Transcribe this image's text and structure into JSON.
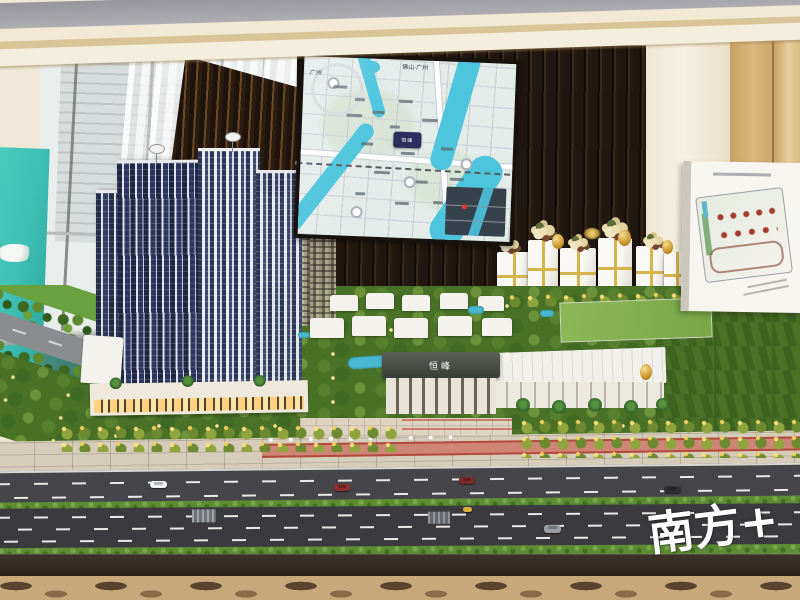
{
  "scene": {
    "kind": "photograph",
    "subject": "real-estate sales center architectural scale model with location map screen"
  },
  "watermark": {
    "text": "南方+",
    "color": "#ffffff"
  },
  "entrance_sign": {
    "text": "恒峰",
    "color": "#ffffff",
    "background": "#454a42"
  },
  "map_screen": {
    "background": "#e4ecea",
    "river_color": "#4cc5dd",
    "logo": {
      "text": "恒峰",
      "background": "#2c2f5e",
      "color": "#ffffff"
    },
    "labels": [
      {
        "text": "佛山·广州"
      },
      {
        "text": "广州"
      }
    ],
    "inset": {
      "background": "#37414c",
      "marker_color": "#e0392b"
    }
  },
  "palette": {
    "ceiling_cream": "#f0e8d2",
    "ceiling_gray": "#a7a7ad",
    "wood_wall": "#241a10",
    "teal_panel": "#3fc0b5",
    "warm_wall": "#cda25f",
    "tower_navy": "#232b4e",
    "garden_green": "#4a7227",
    "road_asphalt": "#3b3b3f",
    "sidewalk": "#d5ccba",
    "bike_lane": "#cf8576",
    "gold_decor": "#c9972f",
    "siteplan_board": "#f7f5f0"
  },
  "cars": [
    {
      "label": "white-car",
      "color": "#eceff2"
    },
    {
      "label": "red-car",
      "color": "#8e2f2f"
    },
    {
      "label": "red-car-2",
      "color": "#7e2a2a"
    },
    {
      "label": "dark-car",
      "color": "#2e2e34"
    },
    {
      "label": "gray-car",
      "color": "#9a9da2"
    },
    {
      "label": "yellow-car",
      "color": "#d9b13a"
    }
  ]
}
